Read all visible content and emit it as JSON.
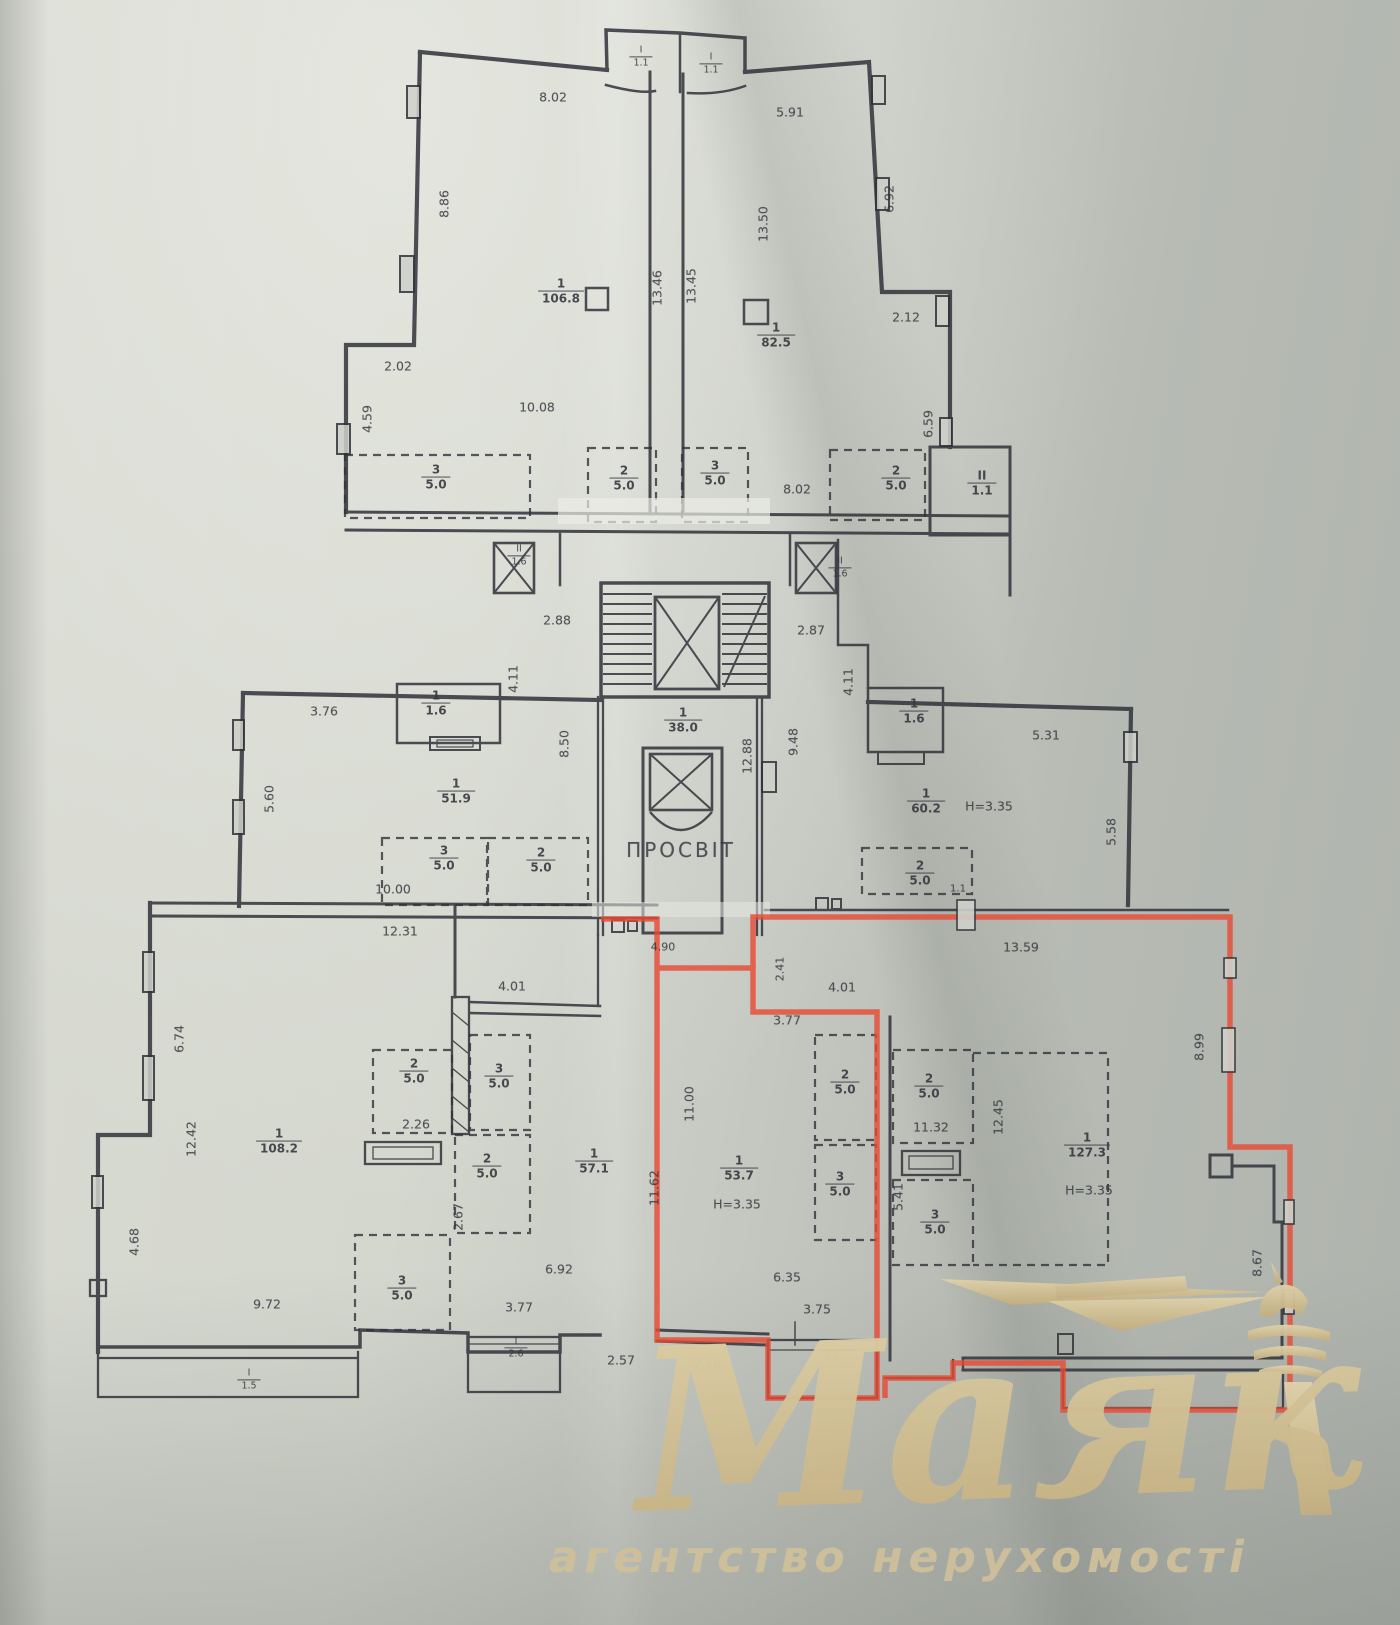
{
  "document": {
    "type": "floor-plan-scan",
    "highlight_color": "#e84a33",
    "ink_color": "#31323a",
    "paper_color": "#ccd0c7"
  },
  "plan": {
    "corridor_room": "ПРОСВІТ",
    "dimensions": [
      {
        "t": "8.02",
        "x": 553,
        "y": 97
      },
      {
        "t": "8.86",
        "x": 444,
        "y": 204,
        "r": -90
      },
      {
        "t": "2.02",
        "x": 398,
        "y": 366
      },
      {
        "t": "10.08",
        "x": 537,
        "y": 407
      },
      {
        "t": "4.59",
        "x": 367,
        "y": 419,
        "r": -90
      },
      {
        "t": "13.46",
        "x": 657,
        "y": 288,
        "r": -90
      },
      {
        "t": "13.45",
        "x": 691,
        "y": 286,
        "r": -90
      },
      {
        "t": "5.91",
        "x": 790,
        "y": 112
      },
      {
        "t": "13.50",
        "x": 763,
        "y": 224,
        "r": -90
      },
      {
        "t": "6.92",
        "x": 889,
        "y": 199,
        "r": -90
      },
      {
        "t": "2.12",
        "x": 906,
        "y": 317
      },
      {
        "t": "6.59",
        "x": 928,
        "y": 424,
        "r": -90
      },
      {
        "t": "8.02",
        "x": 797,
        "y": 489
      },
      {
        "t": "2.88",
        "x": 557,
        "y": 620
      },
      {
        "t": "2.87",
        "x": 811,
        "y": 630
      },
      {
        "t": "4.11",
        "x": 513,
        "y": 679,
        "r": -90
      },
      {
        "t": "4.11",
        "x": 848,
        "y": 682,
        "r": -90
      },
      {
        "t": "8.50",
        "x": 564,
        "y": 744,
        "r": -90
      },
      {
        "t": "12.88",
        "x": 747,
        "y": 756,
        "r": -90
      },
      {
        "t": "9.48",
        "x": 793,
        "y": 742,
        "r": -90
      },
      {
        "t": "ПРОСВІТ",
        "x": 681,
        "y": 850,
        "s": 20,
        "ls": 3
      },
      {
        "t": "3.76",
        "x": 324,
        "y": 711
      },
      {
        "t": "5.60",
        "x": 269,
        "y": 799,
        "r": -90
      },
      {
        "t": "10.00",
        "x": 393,
        "y": 889
      },
      {
        "t": "12.31",
        "x": 400,
        "y": 931
      },
      {
        "t": "5.31",
        "x": 1046,
        "y": 735
      },
      {
        "t": "H=3.35",
        "x": 989,
        "y": 806
      },
      {
        "t": "5.58",
        "x": 1111,
        "y": 832,
        "r": -90
      },
      {
        "t": "1.1",
        "x": 958,
        "y": 889,
        "s": 10
      },
      {
        "t": "13.59",
        "x": 1021,
        "y": 947
      },
      {
        "t": "6.74",
        "x": 179,
        "y": 1039,
        "r": -90
      },
      {
        "t": "12.42",
        "x": 191,
        "y": 1139,
        "r": -90
      },
      {
        "t": "4.68",
        "x": 134,
        "y": 1242,
        "r": -90
      },
      {
        "t": "9.72",
        "x": 267,
        "y": 1304
      },
      {
        "t": "2.26",
        "x": 416,
        "y": 1124
      },
      {
        "t": "2.67",
        "x": 458,
        "y": 1217,
        "r": -90
      },
      {
        "t": "4.01",
        "x": 512,
        "y": 986
      },
      {
        "t": "11.62",
        "x": 654,
        "y": 1188,
        "r": -90
      },
      {
        "t": "6.92",
        "x": 559,
        "y": 1269
      },
      {
        "t": "3.77",
        "x": 519,
        "y": 1307
      },
      {
        "t": "2.57",
        "x": 621,
        "y": 1360
      },
      {
        "t": "2.56",
        "x": 707,
        "y": 1363
      },
      {
        "t": "4.90",
        "x": 663,
        "y": 947,
        "s": 11
      },
      {
        "t": "2.41",
        "x": 780,
        "y": 969,
        "r": -90,
        "s": 11
      },
      {
        "t": "4.01",
        "x": 842,
        "y": 987
      },
      {
        "t": "3.77",
        "x": 787,
        "y": 1020
      },
      {
        "t": "11.00",
        "x": 689,
        "y": 1104,
        "r": -90
      },
      {
        "t": "H=3.35",
        "x": 737,
        "y": 1204
      },
      {
        "t": "6.35",
        "x": 787,
        "y": 1277
      },
      {
        "t": "3.75",
        "x": 817,
        "y": 1309
      },
      {
        "t": "11.32",
        "x": 931,
        "y": 1127
      },
      {
        "t": "5.41",
        "x": 898,
        "y": 1197,
        "r": -90
      },
      {
        "t": "12.45",
        "x": 998,
        "y": 1117,
        "r": -90
      },
      {
        "t": "8.99",
        "x": 1199,
        "y": 1047,
        "r": -90
      },
      {
        "t": "8.67",
        "x": 1257,
        "y": 1263,
        "r": -90
      },
      {
        "t": "H=3.35",
        "x": 1089,
        "y": 1190
      }
    ],
    "areas": [
      {
        "n": "1",
        "d": "106.8",
        "x": 561,
        "y": 292
      },
      {
        "n": "1",
        "d": "82.5",
        "x": 776,
        "y": 336
      },
      {
        "n": "I",
        "d": "1.1",
        "x": 641,
        "y": 57,
        "small": true
      },
      {
        "n": "I",
        "d": "1.1",
        "x": 711,
        "y": 64,
        "small": true
      },
      {
        "n": "3",
        "d": "5.0",
        "x": 436,
        "y": 478
      },
      {
        "n": "2",
        "d": "5.0",
        "x": 624,
        "y": 479
      },
      {
        "n": "3",
        "d": "5.0",
        "x": 715,
        "y": 474
      },
      {
        "n": "2",
        "d": "5.0",
        "x": 896,
        "y": 479
      },
      {
        "n": "II",
        "d": "1.1",
        "x": 982,
        "y": 484
      },
      {
        "n": "II",
        "d": "1.6",
        "x": 519,
        "y": 556,
        "small": true
      },
      {
        "n": "II",
        "d": "1.6",
        "x": 840,
        "y": 568,
        "small": true
      },
      {
        "n": "1",
        "d": "38.0",
        "x": 683,
        "y": 721
      },
      {
        "n": "1",
        "d": "1.6",
        "x": 436,
        "y": 704
      },
      {
        "n": "1",
        "d": "51.9",
        "x": 456,
        "y": 792
      },
      {
        "n": "3",
        "d": "5.0",
        "x": 444,
        "y": 859
      },
      {
        "n": "2",
        "d": "5.0",
        "x": 541,
        "y": 861
      },
      {
        "n": "1",
        "d": "1.6",
        "x": 914,
        "y": 712
      },
      {
        "n": "1",
        "d": "60.2",
        "x": 926,
        "y": 802
      },
      {
        "n": "2",
        "d": "5.0",
        "x": 920,
        "y": 874
      },
      {
        "n": "1",
        "d": "108.2",
        "x": 279,
        "y": 1142
      },
      {
        "n": "2",
        "d": "5.0",
        "x": 414,
        "y": 1072
      },
      {
        "n": "3",
        "d": "5.0",
        "x": 499,
        "y": 1077
      },
      {
        "n": "2",
        "d": "5.0",
        "x": 487,
        "y": 1167
      },
      {
        "n": "3",
        "d": "5.0",
        "x": 402,
        "y": 1289
      },
      {
        "n": "1",
        "d": "57.1",
        "x": 594,
        "y": 1162
      },
      {
        "n": "I",
        "d": "2.6",
        "x": 516,
        "y": 1348,
        "small": true
      },
      {
        "n": "I",
        "d": "1.5",
        "x": 249,
        "y": 1380,
        "small": true
      },
      {
        "n": "1",
        "d": "53.7",
        "x": 739,
        "y": 1169
      },
      {
        "n": "2",
        "d": "5.0",
        "x": 845,
        "y": 1083
      },
      {
        "n": "3",
        "d": "5.0",
        "x": 840,
        "y": 1185
      },
      {
        "n": "I",
        "d": "2.6",
        "x": 832,
        "y": 1351,
        "small": true
      },
      {
        "n": "2",
        "d": "5.0",
        "x": 929,
        "y": 1087
      },
      {
        "n": "3",
        "d": "5.0",
        "x": 935,
        "y": 1223
      },
      {
        "n": "1",
        "d": "127.3",
        "x": 1087,
        "y": 1146
      },
      {
        "n": "I",
        "d": "2.2",
        "x": 1162,
        "y": 1389,
        "small": true
      }
    ]
  },
  "watermark": {
    "name": "Маяк",
    "tagline": "агентство нерухомості",
    "color": "#d3c298"
  }
}
